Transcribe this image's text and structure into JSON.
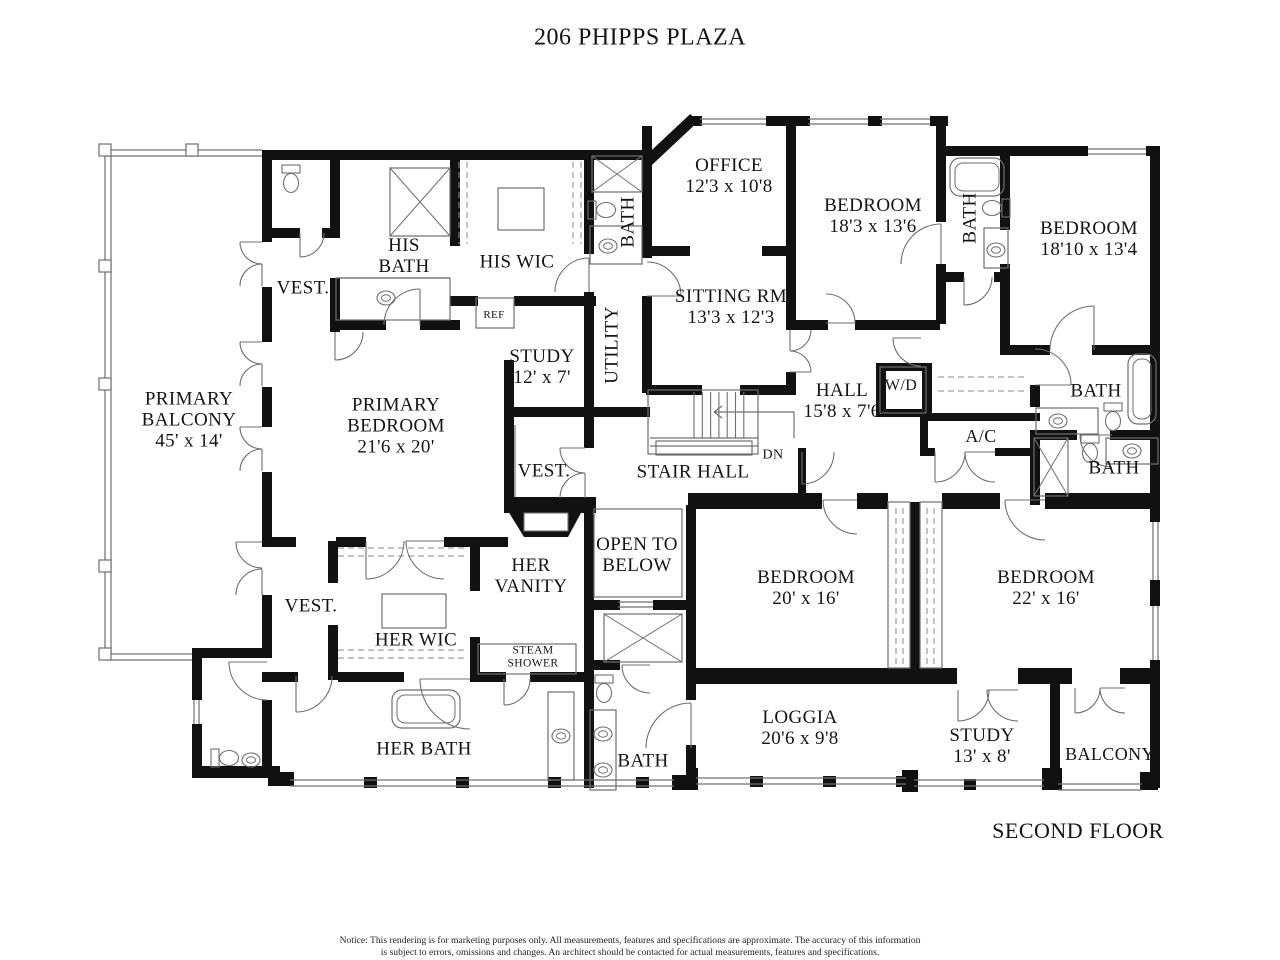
{
  "header": {
    "title": "206 PHIPPS PLAZA"
  },
  "footer": {
    "floor_label": "SECOND FLOOR",
    "notice_line1": "Notice: This rendering is for marketing purposes only. All measurements, features and specifications are approximate. The accuracy of this information",
    "notice_line2": "is subject to errors, omissions and changes. An architect should be contacted for actual measurements, features and specifications."
  },
  "rooms": [
    {
      "id": "primary-balcony",
      "lines": [
        "PRIMARY",
        "BALCONY",
        "45' x 14'"
      ]
    },
    {
      "id": "vest-nw",
      "lines": [
        "VEST."
      ]
    },
    {
      "id": "his-bath",
      "lines": [
        "HIS",
        "BATH"
      ]
    },
    {
      "id": "his-wic",
      "lines": [
        "HIS WIC"
      ]
    },
    {
      "id": "ref",
      "lines": [
        "REF"
      ]
    },
    {
      "id": "study-upper",
      "lines": [
        "STUDY",
        "12' x 7'"
      ]
    },
    {
      "id": "utility",
      "lines": [
        "UTILITY"
      ]
    },
    {
      "id": "bath-strip",
      "lines": [
        "BATH"
      ]
    },
    {
      "id": "primary-bedroom",
      "lines": [
        "PRIMARY",
        "BEDROOM",
        "21'6 x 20'"
      ]
    },
    {
      "id": "office",
      "lines": [
        "OFFICE",
        "12'3 x 10'8"
      ]
    },
    {
      "id": "sitting-rm",
      "lines": [
        "SITTING RM",
        "13'3 x 12'3"
      ]
    },
    {
      "id": "bedroom-ne",
      "lines": [
        "BEDROOM",
        "18'3 x 13'6"
      ]
    },
    {
      "id": "bath-ne",
      "lines": [
        "BATH"
      ]
    },
    {
      "id": "bedroom-e",
      "lines": [
        "BEDROOM",
        "18'10 x 13'4"
      ]
    },
    {
      "id": "hall",
      "lines": [
        "HALL",
        "15'8 x 7'6"
      ]
    },
    {
      "id": "wd",
      "lines": [
        "W/D"
      ]
    },
    {
      "id": "bath-e1",
      "lines": [
        "BATH"
      ]
    },
    {
      "id": "ac",
      "lines": [
        "A/C"
      ]
    },
    {
      "id": "bath-e2",
      "lines": [
        "BATH"
      ]
    },
    {
      "id": "vest-mid",
      "lines": [
        "VEST."
      ]
    },
    {
      "id": "stair-hall",
      "lines": [
        "STAIR HALL"
      ]
    },
    {
      "id": "dn",
      "lines": [
        "DN"
      ]
    },
    {
      "id": "open-below",
      "lines": [
        "OPEN TO",
        "BELOW"
      ]
    },
    {
      "id": "her-vanity",
      "lines": [
        "HER",
        "VANITY"
      ]
    },
    {
      "id": "vest-sw",
      "lines": [
        "VEST."
      ]
    },
    {
      "id": "her-wic",
      "lines": [
        "HER WIC"
      ]
    },
    {
      "id": "steam-shower",
      "lines": [
        "STEAM",
        "SHOWER"
      ]
    },
    {
      "id": "her-bath",
      "lines": [
        "HER BATH"
      ]
    },
    {
      "id": "bath-s",
      "lines": [
        "BATH"
      ]
    },
    {
      "id": "bedroom-s1",
      "lines": [
        "BEDROOM",
        "20' x 16'"
      ]
    },
    {
      "id": "bedroom-s2",
      "lines": [
        "BEDROOM",
        "22' x 16'"
      ]
    },
    {
      "id": "loggia",
      "lines": [
        "LOGGIA",
        "20'6 x 9'8"
      ]
    },
    {
      "id": "study-s",
      "lines": [
        "STUDY",
        "13' x 8'"
      ]
    },
    {
      "id": "balcony-se",
      "lines": [
        "BALCONY"
      ]
    }
  ],
  "colors": {
    "wall": "#111111",
    "line": "#6f6f6f",
    "dash": "#8a8a8a",
    "text": "#141414"
  }
}
